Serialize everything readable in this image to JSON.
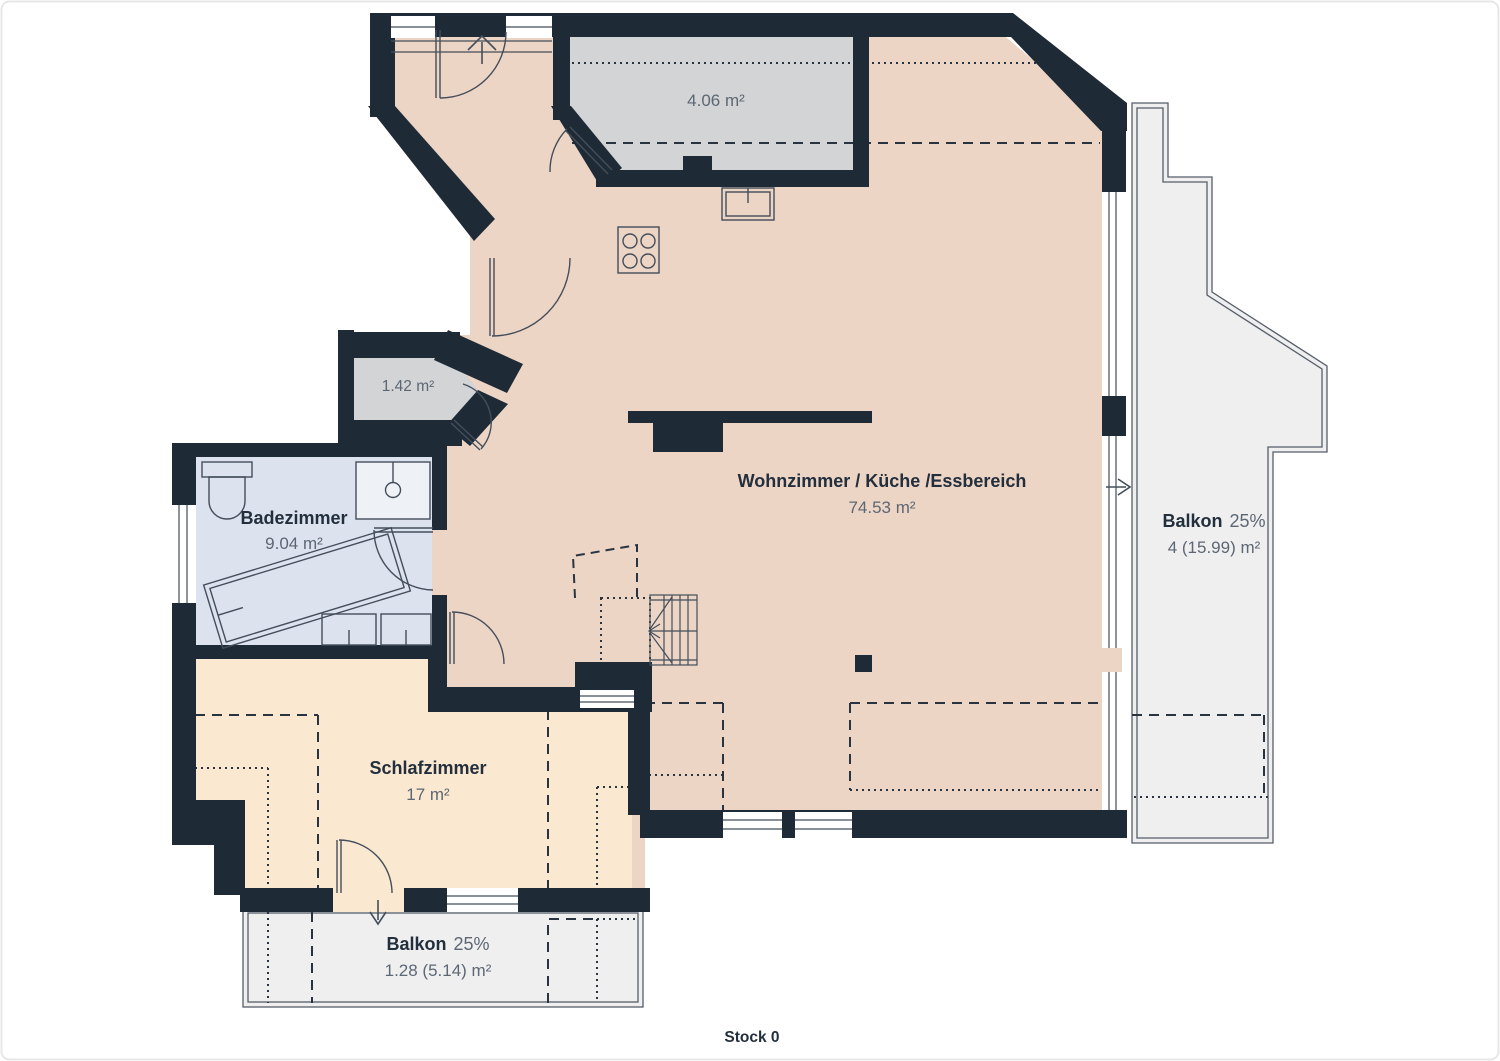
{
  "floor": {
    "label": "Stock 0"
  },
  "rooms": {
    "living": {
      "name": "Wohnzimmer / Küche /Essbereich",
      "area": "74.53 m²"
    },
    "bedroom": {
      "name": "Schlafzimmer",
      "area": "17 m²"
    },
    "bathroom": {
      "name": "Badezimmer",
      "area": "9.04 m²"
    },
    "storage_top": {
      "area": "4.06 m²"
    },
    "storage_small": {
      "area": "1.42 m²"
    },
    "balcony_right": {
      "name": "Balkon",
      "factor": "25%",
      "area": "4 (15.99) m²"
    },
    "balcony_bottom": {
      "name": "Balkon",
      "factor": "25%",
      "area": "1.28 (5.14) m²"
    }
  },
  "colors": {
    "wall": "#1f2a37",
    "living": "#edd5c5",
    "bedroom": "#fae8d1",
    "bathroom": "#dce2ee",
    "storage": "#d2d4d6",
    "balcony": "#efeff0",
    "fixture_fill": "#eef1f6",
    "line": "#2a3440",
    "stroke": "#444e5b",
    "text_dark": "#232f3d",
    "text_gray": "#5d6774",
    "page_border": "#e7e7e7"
  }
}
